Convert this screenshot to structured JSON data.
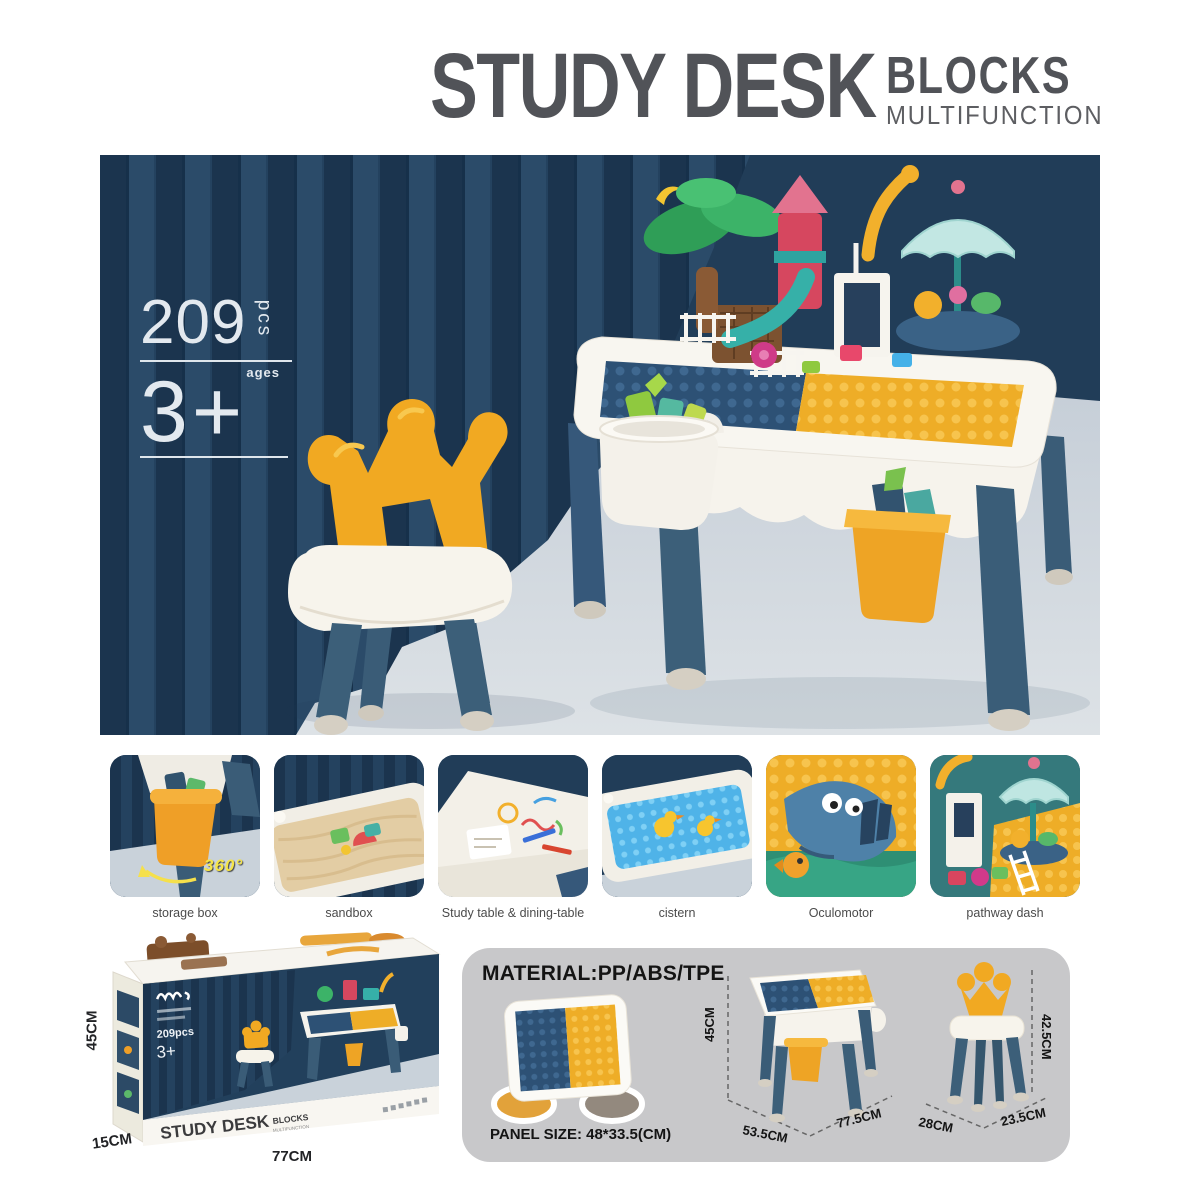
{
  "header": {
    "title": "STUDY DESK",
    "subtitle": "BLOCKS",
    "tagline": "MULTIFUNCTION"
  },
  "hero_badge": {
    "pieces": "209",
    "unit": "pcs",
    "ages_label": "ages",
    "age": "3+"
  },
  "features": [
    {
      "caption": "storage box",
      "overlay": "360°"
    },
    {
      "caption": "sandbox"
    },
    {
      "caption": "Study table & dining-table"
    },
    {
      "caption": "cistern"
    },
    {
      "caption": "Oculomotor"
    },
    {
      "caption": "pathway dash"
    }
  ],
  "packaging": {
    "front_title": "STUDY DESK",
    "front_subtitle": "BLOCKS",
    "front_tagline": "MULTIFUNCTION",
    "mini_pieces": "209pcs",
    "mini_age": "3+",
    "dim_height": "45CM",
    "dim_depth": "15CM",
    "dim_width": "77CM"
  },
  "specs": {
    "material": "MATERIAL:PP/ABS/TPE",
    "panel_size": "PANEL SIZE: 48*33.5(CM)",
    "table": {
      "height": "45CM",
      "depth": "53.5CM",
      "width": "77.5CM"
    },
    "chair": {
      "depth": "28CM",
      "width": "23.5CM",
      "height": "42.5CM"
    }
  },
  "icons": {
    "rotation_arrow": "360-rotation-arrow",
    "certification": "safety-certification-marks",
    "brand_logo": "brand-script-logo"
  },
  "colors": {
    "navy_background": "#213d58",
    "curtain_dark": "#1b344e",
    "curtain_light": "#2b4b69",
    "floor": "#ccd5dc",
    "accent_yellow": "#f1a922",
    "leg_blue": "#3c5f79",
    "stud_blue": "#2d5175",
    "stud_yellow": "#eead27",
    "spec_panel_gray": "#c8c8ca",
    "title_gray": "#515358"
  }
}
